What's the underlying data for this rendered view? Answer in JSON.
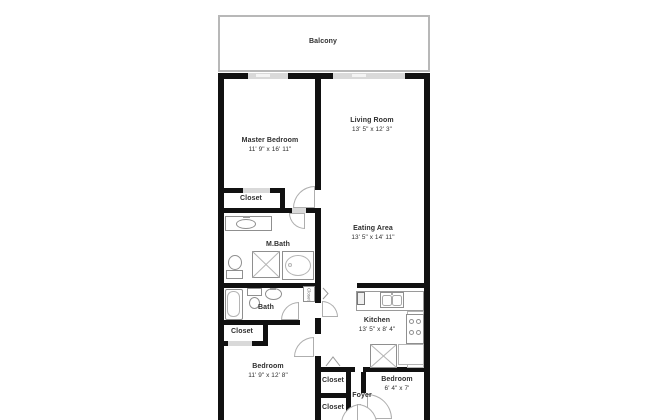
{
  "balcony": {
    "label": "Balcony"
  },
  "rooms": {
    "master_bedroom": {
      "name": "Master Bedroom",
      "dims": "11' 9\" x 16' 11\""
    },
    "living_room": {
      "name": "Living Room",
      "dims": "13' 5\" x 12' 3\""
    },
    "eating_area": {
      "name": "Eating Area",
      "dims": "13' 5\" x 14' 11\""
    },
    "kitchen": {
      "name": "Kitchen",
      "dims": "13' 5\" x 8' 4\""
    },
    "bedroom": {
      "name": "Bedroom",
      "dims": "11' 9\" x 12' 8\""
    },
    "bedroom_small": {
      "name": "Bedroom",
      "dims": "6' 4\" x 7'"
    },
    "master_bath": {
      "name": "M.Bath"
    },
    "bath": {
      "name": "Bath"
    },
    "foyer": {
      "name": "Foyer"
    }
  },
  "closets": {
    "master": "Closet",
    "bath": "Closet",
    "hall_upper": "Closet",
    "hall_lower": "Closet",
    "linen": "Closet"
  },
  "colors": {
    "wall": "#111111",
    "door_gap": "#d9d9d9",
    "fixture": "#8f8f8f",
    "fixture_light": "#b5b5b5",
    "balcony_border": "#b8b8b8",
    "text": "#2f2f2f"
  }
}
